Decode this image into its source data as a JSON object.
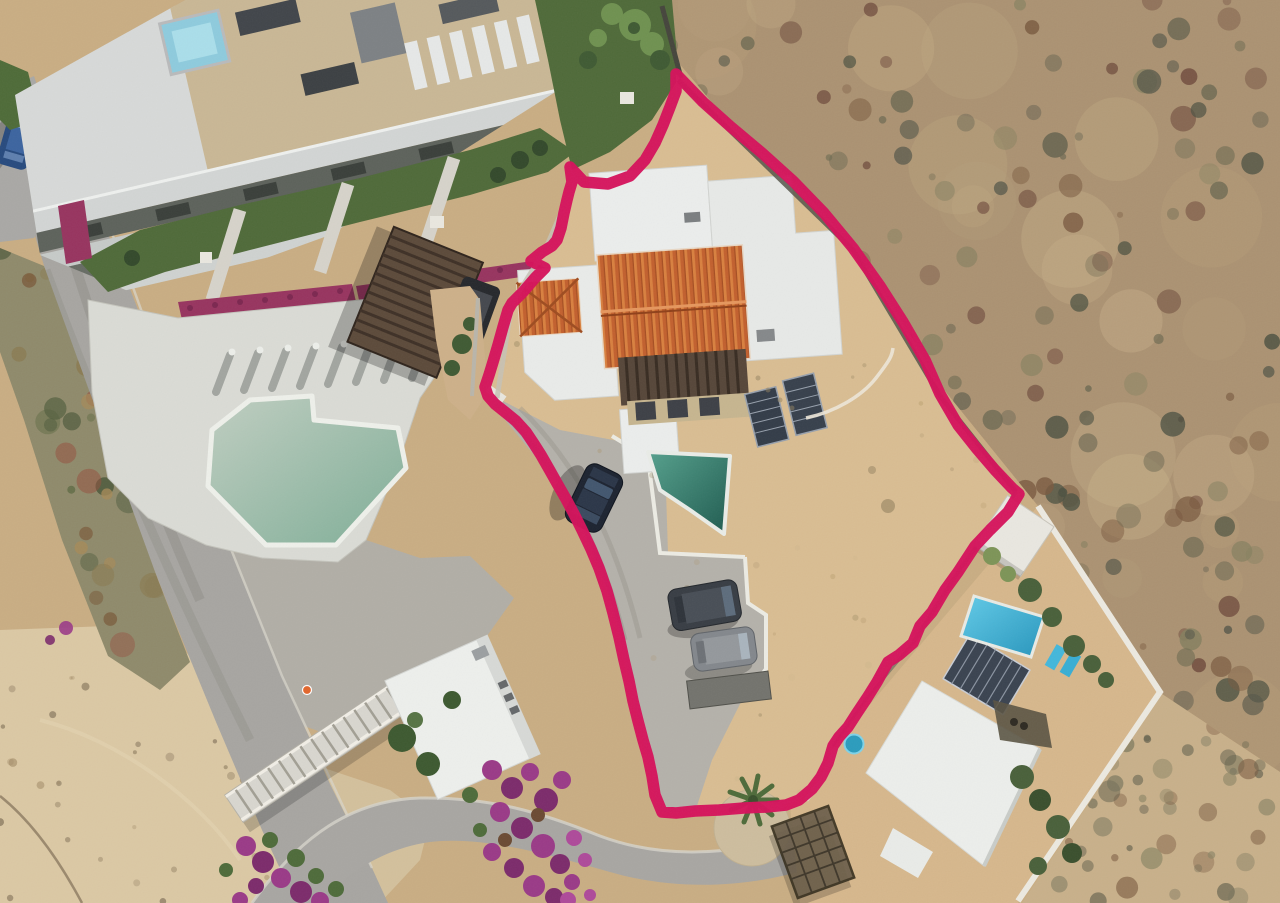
{
  "meta": {
    "type": "aerial-drone-photograph",
    "description": "Overhead drone photo of a coastal residential lot outlined with a thick hand-drawn magenta boundary. Left: modern condo complex with rooftop spa, sun loungers, lawn, pergola and large pale-teal pool. Center: subject villa with orange clay-tile gable roof, white flat roofs, small infinity pool, driveway with one sedan and two SUVs on a dirt lot. Right: untouched desert scrub. Bottom-right: neighboring walled villa with bright blue pool, solar panels, palm trees and a lattice gazebo. Bottom-left: beach sand, a stepped walkway bridge, a small white flat-roof building and magenta bougainvillea.",
    "width": 1280,
    "height": 903
  },
  "boundary": {
    "label": "hand-drawn property boundary with arrow hook near north gate",
    "color": "#d5125b",
    "stroke_width": 11.5,
    "closed": true,
    "points": [
      [
        676,
        74
      ],
      [
        703,
        102
      ],
      [
        731,
        127
      ],
      [
        762,
        153
      ],
      [
        793,
        181
      ],
      [
        824,
        213
      ],
      [
        853,
        248
      ],
      [
        880,
        286
      ],
      [
        903,
        322
      ],
      [
        925,
        360
      ],
      [
        940,
        394
      ],
      [
        958,
        425
      ],
      [
        977,
        449
      ],
      [
        995,
        470
      ],
      [
        1012,
        488
      ],
      [
        1019,
        494
      ],
      [
        1008,
        512
      ],
      [
        990,
        530
      ],
      [
        975,
        546
      ],
      [
        958,
        572
      ],
      [
        945,
        590
      ],
      [
        932,
        612
      ],
      [
        920,
        626
      ],
      [
        913,
        643
      ],
      [
        899,
        655
      ],
      [
        888,
        662
      ],
      [
        877,
        682
      ],
      [
        867,
        698
      ],
      [
        857,
        713
      ],
      [
        848,
        727
      ],
      [
        839,
        737
      ],
      [
        833,
        746
      ],
      [
        828,
        763
      ],
      [
        821,
        777
      ],
      [
        812,
        789
      ],
      [
        799,
        800
      ],
      [
        786,
        805
      ],
      [
        767,
        807
      ],
      [
        744,
        808
      ],
      [
        719,
        810
      ],
      [
        695,
        811
      ],
      [
        676,
        813
      ],
      [
        662,
        812
      ],
      [
        655,
        795
      ],
      [
        652,
        776
      ],
      [
        648,
        757
      ],
      [
        643,
        740
      ],
      [
        638,
        721
      ],
      [
        633,
        701
      ],
      [
        629,
        681
      ],
      [
        624,
        660
      ],
      [
        619,
        637
      ],
      [
        613,
        613
      ],
      [
        607,
        591
      ],
      [
        599,
        568
      ],
      [
        591,
        549
      ],
      [
        582,
        530
      ],
      [
        574,
        514
      ],
      [
        566,
        499
      ],
      [
        558,
        485
      ],
      [
        549,
        469
      ],
      [
        541,
        455
      ],
      [
        534,
        444
      ],
      [
        526,
        432
      ],
      [
        516,
        421
      ],
      [
        505,
        412
      ],
      [
        495,
        404
      ],
      [
        488,
        396
      ],
      [
        485,
        387
      ],
      [
        489,
        375
      ],
      [
        493,
        362
      ],
      [
        498,
        345
      ],
      [
        503,
        327
      ],
      [
        508,
        310
      ],
      [
        512,
        303
      ],
      [
        523,
        292
      ],
      [
        535,
        278
      ],
      [
        545,
        268
      ],
      [
        531,
        261
      ],
      [
        542,
        252
      ],
      [
        552,
        246
      ],
      [
        557,
        240
      ],
      [
        561,
        228
      ],
      [
        564,
        213
      ],
      [
        567,
        200
      ],
      [
        569,
        192
      ],
      [
        572,
        182
      ],
      [
        570,
        167
      ],
      [
        584,
        182
      ],
      [
        608,
        184
      ],
      [
        630,
        176
      ],
      [
        645,
        160
      ],
      [
        655,
        143
      ],
      [
        663,
        125
      ],
      [
        670,
        107
      ],
      [
        676,
        91
      ],
      [
        676,
        74
      ]
    ]
  },
  "palette": {
    "boundary_pink": "#d5125b",
    "base_sand": "#c9ad83",
    "lot_sand": "#d9bd92",
    "beach_sand": "#dbc8a4",
    "desert_base": "#ab9272",
    "road_gray": "#a7a5a1",
    "driveway_gray": "#b4b1aa",
    "lawn_green": "#4f6a39",
    "white_roof": "#ebedec",
    "orange_tile": "#c2602e",
    "condo_pool": "#9cbfad",
    "subject_pool": "#2f7a6c",
    "neighbor_pool": "#32aed4",
    "pergola_brown": "#5c4a3a",
    "bougainvillea": "#9a3a87"
  },
  "objects": [
    {
      "name": "property-boundary-line",
      "label": "magenta lot outline"
    },
    {
      "name": "condo-building",
      "label": "condo complex with terraced balconies"
    },
    {
      "name": "condo-rooftop-spa",
      "label": "light blue rooftop spa"
    },
    {
      "name": "condo-rooftop-loungers",
      "label": "white rooftop sun loungers"
    },
    {
      "name": "condo-lawn",
      "label": "green lawn with palms and paths"
    },
    {
      "name": "condo-pool",
      "label": "large pale teal pool"
    },
    {
      "name": "condo-pergola",
      "label": "dark slatted pergola"
    },
    {
      "name": "parked-truck",
      "label": "dark pickup by pergola"
    },
    {
      "name": "street",
      "label": "gray access road along west side"
    },
    {
      "name": "parked-blue-car",
      "label": "blue sedan on street"
    },
    {
      "name": "subject-house",
      "label": "villa with orange tile and white flat roofs"
    },
    {
      "name": "subject-pool",
      "label": "small dark-teal infinity pool"
    },
    {
      "name": "sedan-car",
      "label": "dark sedan on driveway"
    },
    {
      "name": "suv-dark",
      "label": "dark gray SUV"
    },
    {
      "name": "suv-gray",
      "label": "light gray SUV"
    },
    {
      "name": "solar-water-heaters",
      "label": "two dark rooftop panels"
    },
    {
      "name": "garden-hose",
      "label": "white hose arc on dirt lot"
    },
    {
      "name": "neighbor-villa",
      "label": "white-walled neighbor house"
    },
    {
      "name": "neighbor-pool",
      "label": "bright blue pool"
    },
    {
      "name": "neighbor-solar-panels",
      "label": "solar array"
    },
    {
      "name": "gazebo",
      "label": "wood lattice gazebo"
    },
    {
      "name": "palm-tree",
      "label": "palm at cul-de-sac"
    },
    {
      "name": "water-tank",
      "label": "cyan water tank"
    },
    {
      "name": "desert-scrub",
      "label": "mottled desert brush"
    },
    {
      "name": "stairs-walkway",
      "label": "stepped pedestrian bridge"
    },
    {
      "name": "small-white-building",
      "label": "flat-roof outbuilding"
    },
    {
      "name": "bougainvillea",
      "label": "magenta flower clusters"
    },
    {
      "name": "traffic-cone",
      "label": "orange cone on pavement"
    }
  ],
  "scatter": [
    {
      "id": "g-desert-ne-dark",
      "seed": 7,
      "count": 260,
      "x": 610,
      "y": 0,
      "w": 670,
      "h": 780,
      "rmin": 3,
      "rmax": 13,
      "opacity": [
        0.35,
        0.85
      ],
      "colors": [
        "#6e6a52",
        "#7a5a40",
        "#6f4b3d",
        "#57584a",
        "#84805f",
        "#4d5242"
      ]
    },
    {
      "id": "g-desert-ne-light",
      "seed": 21,
      "count": 40,
      "x": 640,
      "y": 0,
      "w": 640,
      "h": 760,
      "rmin": 18,
      "rmax": 55,
      "opacity": [
        0.18,
        0.4
      ],
      "colors": [
        "#c6ae87",
        "#cdb58e",
        "#b89f79"
      ]
    },
    {
      "id": "g-desert-se-dark",
      "seed": 11,
      "count": 70,
      "x": 1010,
      "y": 690,
      "w": 270,
      "h": 213,
      "rmin": 3,
      "rmax": 11,
      "opacity": [
        0.3,
        0.7
      ],
      "colors": [
        "#77745c",
        "#7a5a40",
        "#8a8464",
        "#5d5c4a"
      ]
    },
    {
      "id": "g-scrub-left",
      "seed": 5,
      "count": 90,
      "x": 0,
      "y": 246,
      "w": 200,
      "h": 460,
      "rmin": 4,
      "rmax": 13,
      "opacity": [
        0.4,
        0.9
      ],
      "colors": [
        "#5f6b45",
        "#7a5a3a",
        "#8a7a50",
        "#4e5a3c",
        "#96503f",
        "#a78a58"
      ]
    },
    {
      "id": "g-beach-pebbles",
      "seed": 13,
      "count": 40,
      "x": 0,
      "y": 624,
      "w": 320,
      "h": 279,
      "rmin": 1.5,
      "rmax": 4.5,
      "opacity": [
        0.3,
        0.6
      ],
      "colors": [
        "#8a795c",
        "#a08a66",
        "#6f5f49"
      ]
    },
    {
      "id": "g-lot-speckle",
      "seed": 17,
      "count": 60,
      "x": 490,
      "y": 300,
      "w": 520,
      "h": 500,
      "rmin": 1.5,
      "rmax": 4,
      "opacity": [
        0.15,
        0.35
      ],
      "colors": [
        "#a8905f",
        "#8a7a56",
        "#c9b289"
      ]
    }
  ]
}
